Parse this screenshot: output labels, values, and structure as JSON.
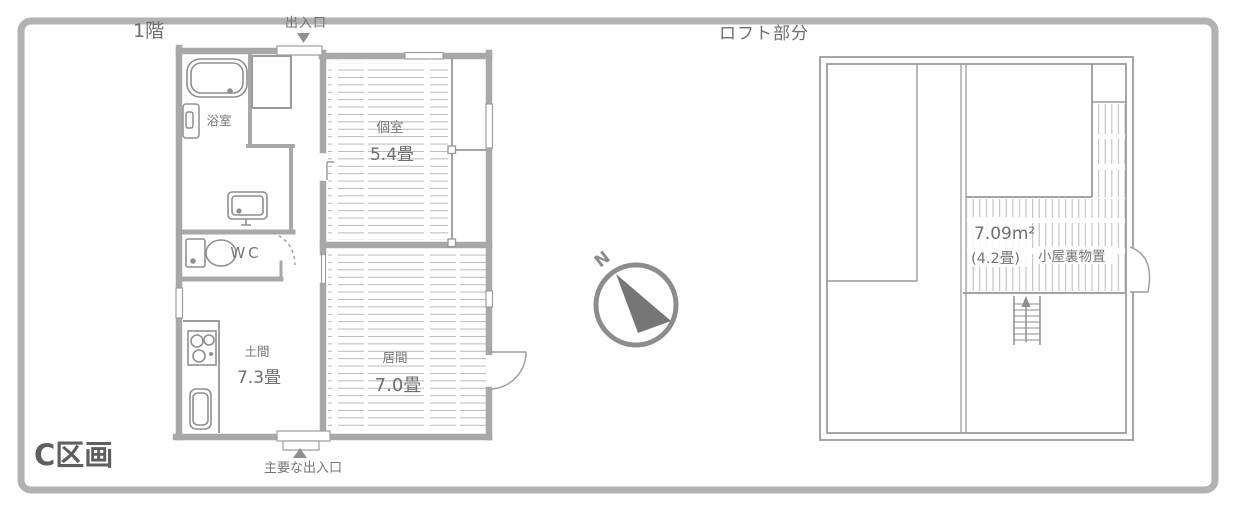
{
  "section_label": "C区画",
  "first_floor": {
    "title": "1階",
    "top_entrance_label": "出入口",
    "main_entrance_label": "主要な出入口",
    "rooms": {
      "bath": {
        "name": "浴室"
      },
      "toilet": {
        "name": "WC"
      },
      "private_room": {
        "name": "個室",
        "size": "5.4畳"
      },
      "doma": {
        "name": "土間",
        "size": "7.3畳"
      },
      "living_room": {
        "name": "居間",
        "size": "7.0畳"
      }
    }
  },
  "loft": {
    "title": "ロフト部分",
    "attic_storage": {
      "area_sqm": "7.09m²",
      "area_tatami": "(4.2畳)",
      "name": "小屋裏物置"
    }
  },
  "compass": {
    "north_label": "N"
  },
  "colors": {
    "border": "#b2b2b2",
    "wall": "#a8a8a8",
    "thin_line": "#979797",
    "fixture": "#8f8f8f",
    "hatch": "#b9b9b9",
    "text": "#757575",
    "section_text": "#5f5f5f",
    "needle": "#767676"
  }
}
